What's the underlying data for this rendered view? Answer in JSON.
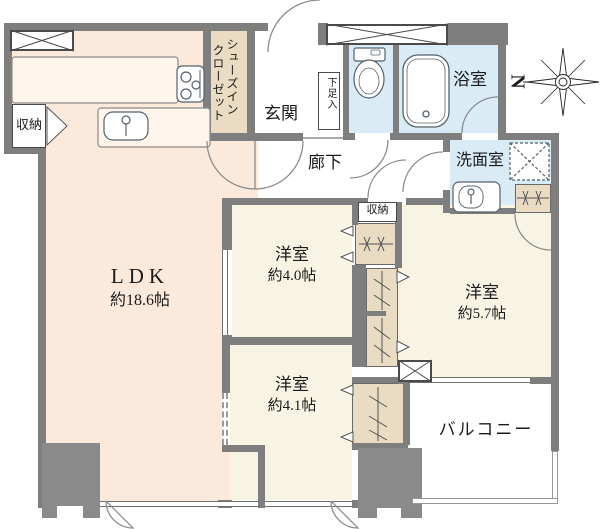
{
  "floorplan": {
    "compass": {
      "north_label": "N"
    },
    "rooms": {
      "ldk": {
        "name": "LDK",
        "size": "約18.6帖"
      },
      "shoes_in_closet": {
        "name": "シューズインクローゼット",
        "line1": "シューズイン",
        "line2": "クローゼット"
      },
      "entrance": {
        "name": "玄関"
      },
      "shoe_cabinet": {
        "name": "下足入"
      },
      "hallway": {
        "name": "廊下"
      },
      "bathroom": {
        "name": "浴室"
      },
      "washroom": {
        "name": "洗面室"
      },
      "storage_ldk": {
        "name": "収納"
      },
      "storage_hall": {
        "name": "収納"
      },
      "bedroom_4_0": {
        "name": "洋室",
        "size": "約4.0帖"
      },
      "bedroom_5_7": {
        "name": "洋室",
        "size": "約5.7帖"
      },
      "bedroom_4_1": {
        "name": "洋室",
        "size": "約4.1帖"
      },
      "balcony": {
        "name": "バルコニー"
      }
    },
    "colors": {
      "wall": "#7e7e7e",
      "ldk_floor": "#fbe9db",
      "room_floor": "#f8f4e4",
      "wet_floor": "#d9ecf5",
      "closet_floor": "#e9dcc2",
      "fixture_outline": "#4d5a66"
    }
  }
}
